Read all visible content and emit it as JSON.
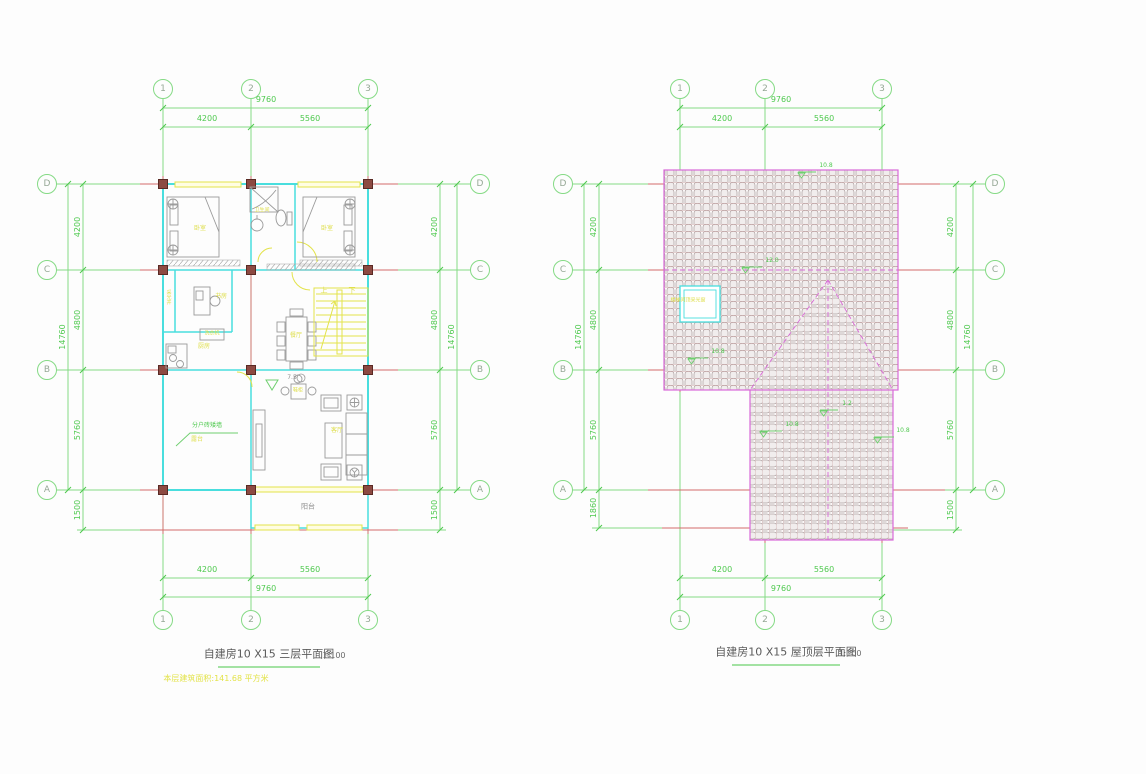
{
  "colors": {
    "grid_green": "#85da85",
    "axis_red": "#d46a6a",
    "wall_cyan": "#49dede",
    "annotation_yellow": "#dede4a",
    "roof_magenta": "#d96ad9"
  },
  "left": {
    "title": "自建房10 X15 三层平面图",
    "scale_label": "1:100",
    "note": "本层建筑面积:141.68 平方米",
    "grid": {
      "cols": [
        "1",
        "2",
        "3"
      ],
      "rows": [
        "D",
        "C",
        "B",
        "A"
      ]
    },
    "dims": {
      "total_w": "9760",
      "seg_w": [
        "4200",
        "5560"
      ],
      "total_h": "14760",
      "seg_h": [
        "4200",
        "4800",
        "5760"
      ],
      "extra_left": "1500",
      "extra_right": "1500"
    },
    "rooms": {
      "bedroom1": "卧室",
      "bath": "卫生间",
      "bedroom2": "卧室",
      "lightwell": "采光井",
      "study": "书房",
      "washer": "洗衣机",
      "kitchen": "厨房",
      "dining": "餐厅",
      "living": "客厅",
      "terrace": "露台",
      "balcony": "阳台",
      "entry_cabinet": "鞋柜"
    },
    "stairs": {
      "up": "上",
      "down": "下"
    },
    "leader": "分户砖矮墙",
    "marker": "7.5"
  },
  "right": {
    "title": "自建房10 X15 屋顶层平面图",
    "scale_label": "1:100",
    "grid": {
      "cols": [
        "1",
        "2",
        "3"
      ],
      "rows": [
        "D",
        "C",
        "B",
        "A"
      ]
    },
    "dims": {
      "total_w": "9760",
      "seg_w": [
        "4200",
        "5560"
      ],
      "total_h": "14760",
      "seg_h": [
        "4200",
        "4800",
        "5760"
      ],
      "extra_left": "1860",
      "extra_right": "1500"
    },
    "slopes": [
      "10.8",
      "12.0",
      "10.8",
      "1.2",
      "10.8",
      "10.8"
    ],
    "skylight": "楼梯间顶采光窗"
  }
}
